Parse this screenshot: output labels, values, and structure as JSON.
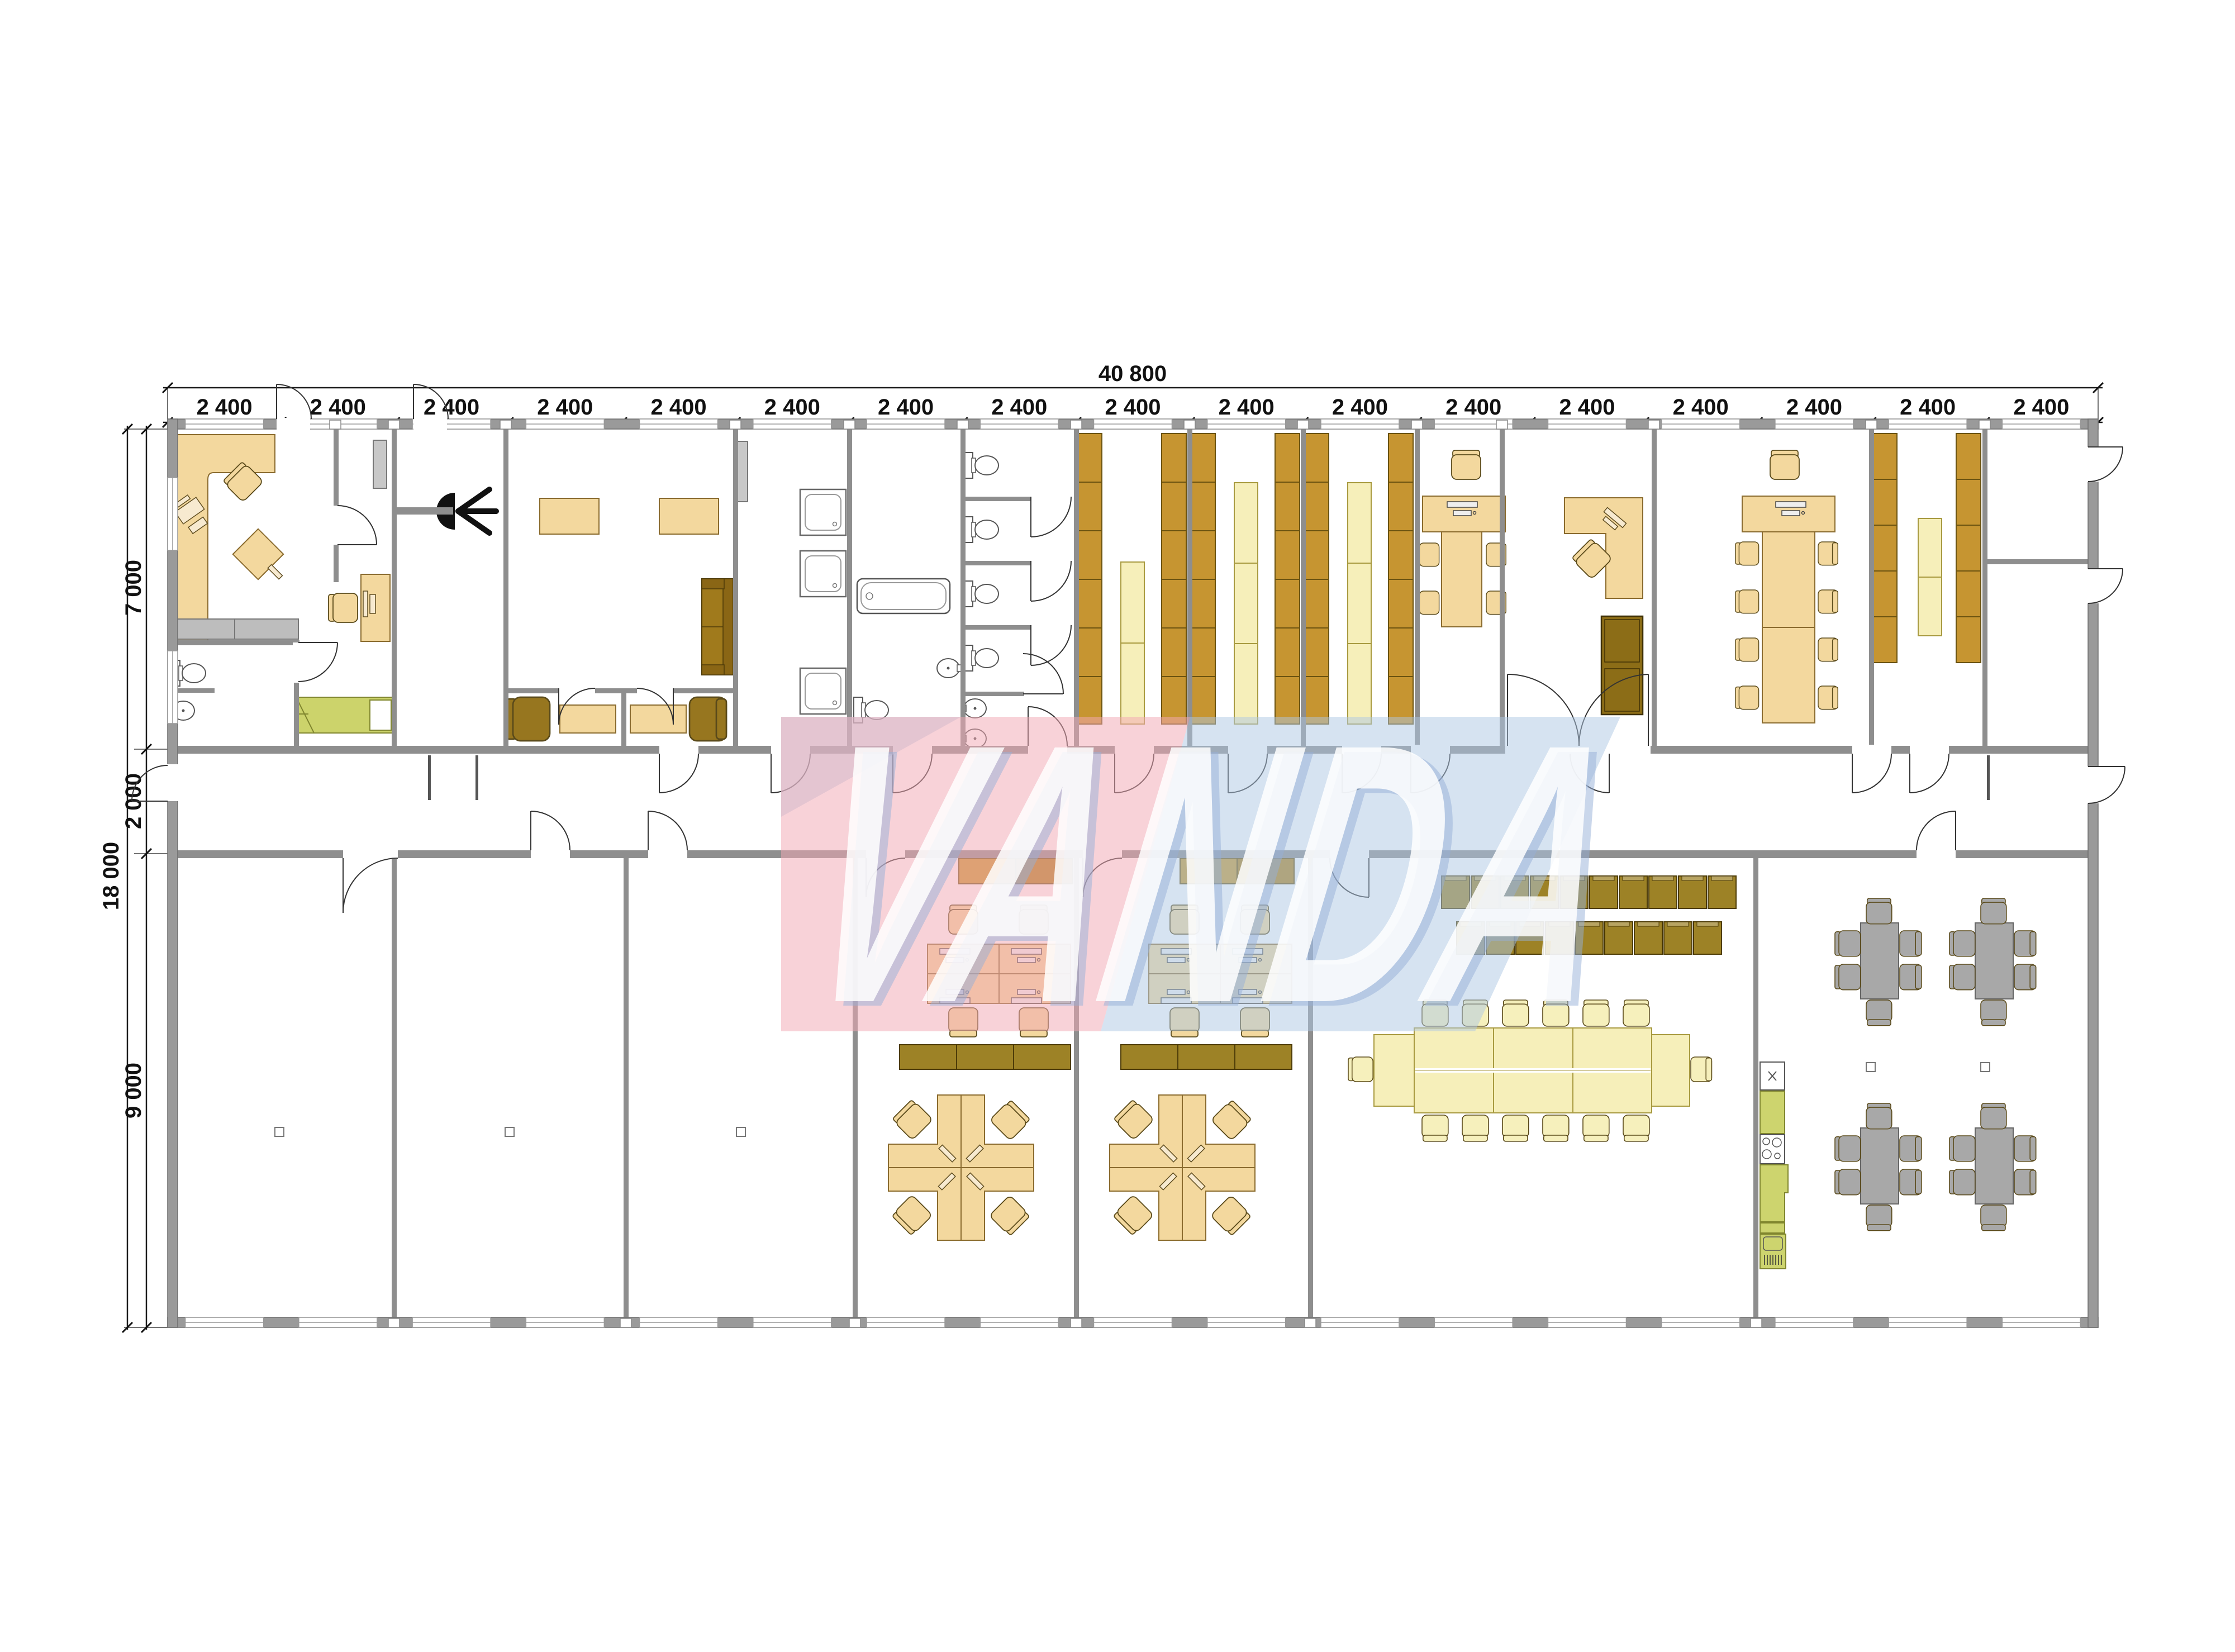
{
  "page": {
    "background": "#ffffff",
    "type": "architectural-floor-plan"
  },
  "watermark": {
    "text": "VANDA",
    "pink_color": "#f2a9b4",
    "blue_color": "#aec8e4",
    "letter_color": "#ffffff"
  },
  "dimensions": {
    "overall_width_label": "40 800",
    "overall_height_label": "18 000",
    "segment_label": "2 400",
    "segment_count": 17,
    "height_segment_labels": [
      "7 000",
      "2 000",
      "9 000"
    ]
  },
  "colors": {
    "wall": "#8e8e8e",
    "furniture_tan": "#f3d89e",
    "furniture_outline": "#8a6b2e",
    "shelf_brown": "#c69531",
    "shelf_pale": "#f6efba",
    "cabinet_dark": "#8c6d17",
    "locker_olive": "#9d8226",
    "bed_green": "#ccd36b",
    "kitchen_green": "#cdd46e",
    "table_gray": "#a8a8a8"
  },
  "symbols": {
    "desk": "desk-icon",
    "office_chair": "chair-icon",
    "computer": "computer-icon",
    "toilet": "toilet-icon",
    "sink": "sink-icon",
    "shower": "shower-icon",
    "bathtub": "bathtub-icon",
    "bed": "bed-icon",
    "sofa": "sofa-icon",
    "shelf": "shelf-icon",
    "locker": "locker-icon",
    "conference_table": "conference-table-icon",
    "dining_table": "dining-table-icon",
    "kitchen_unit": "kitchen-unit-icon",
    "stove": "stove-icon",
    "fridge": "fridge-icon",
    "ceiling_lamp": "ceiling-lamp-icon",
    "door": "door",
    "window": "window",
    "column": "column-marker"
  }
}
